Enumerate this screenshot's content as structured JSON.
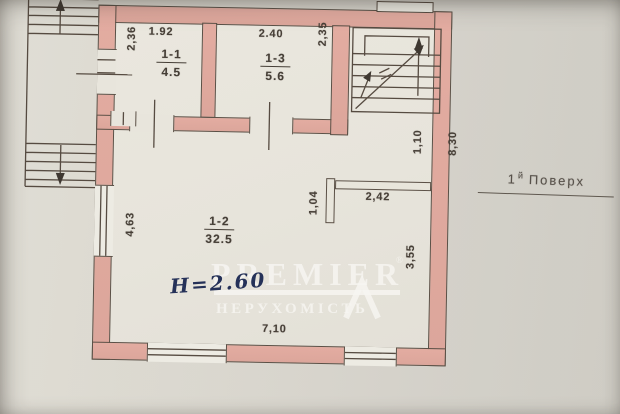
{
  "floor_label": {
    "number": "1",
    "suffix": "й",
    "word": "Поверх"
  },
  "watermark": {
    "brand": "PREMIER",
    "registered": "®",
    "subtitle": "НЕРУХОМІСТЬ"
  },
  "handwritten_note": "Н=2.60",
  "rooms": [
    {
      "id": "1-1",
      "area": "4.5"
    },
    {
      "id": "1-3",
      "area": "5.6"
    },
    {
      "id": "1-2",
      "area": "32.5"
    }
  ],
  "dims": {
    "room11_width": "1.92",
    "room11_depth": "2,36",
    "room13_width": "2.40",
    "room13_depth": "2,35",
    "stair_opening": "1,10",
    "right_wall": "8,30",
    "partition_length": "2,42",
    "partition_return": "1,04",
    "left_window": "4,63",
    "right_side": "3,55",
    "bottom_width": "7,10"
  },
  "colors": {
    "walls": "#e0aaa0",
    "paper": "#d5d2c9",
    "rooms_fill": "#e8e5dc",
    "drawing_line": "#5b5046",
    "ink_note": "#253158",
    "watermark_text": "#f6f5f1"
  }
}
